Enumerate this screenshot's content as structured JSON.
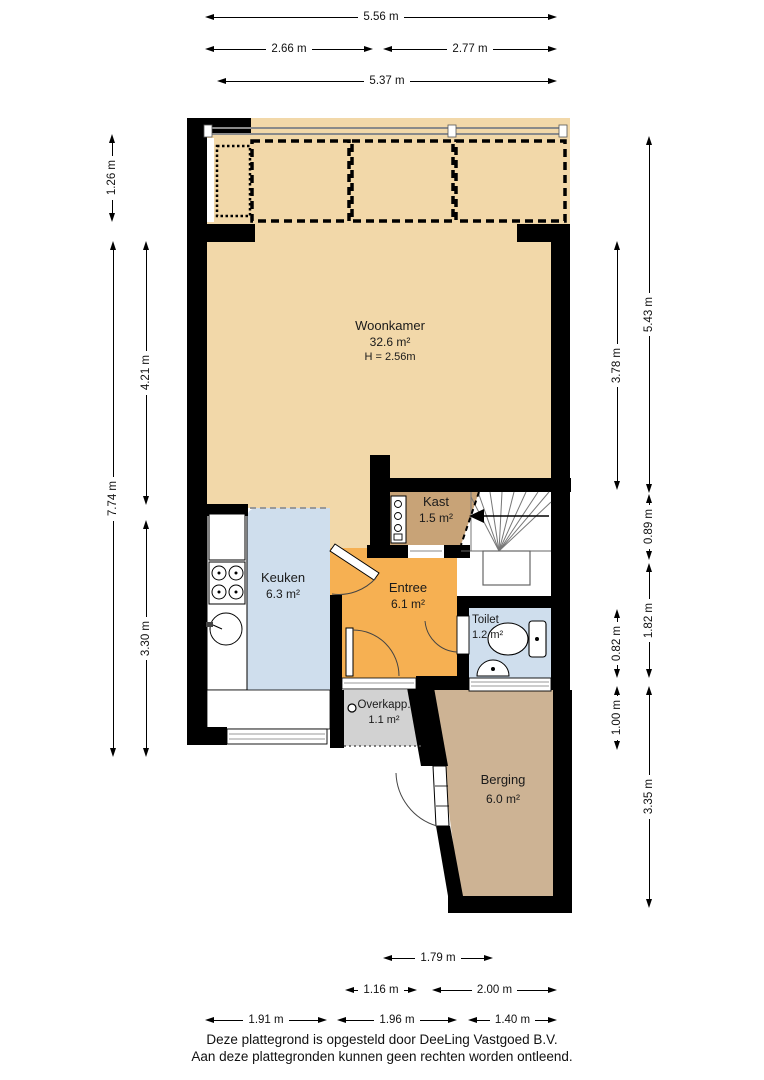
{
  "rooms": {
    "woonkamer": {
      "name": "Woonkamer",
      "area": "32.6 m²",
      "ceiling": "H = 2.56m"
    },
    "kast": {
      "name": "Kast",
      "area": "1.5 m²"
    },
    "keuken": {
      "name": "Keuken",
      "area": "6.3 m²"
    },
    "entree": {
      "name": "Entree",
      "area": "6.1 m²"
    },
    "toilet": {
      "name": "Toilet",
      "area": "1.2 m²"
    },
    "overkapping": {
      "name": "Overkapp.",
      "area": "1.1 m²"
    },
    "berging": {
      "name": "Berging",
      "area": "6.0 m²"
    }
  },
  "dimensions": {
    "top": [
      "5.56 m",
      "2.66 m",
      "2.77 m",
      "5.37 m"
    ],
    "left": [
      "1.26 m",
      "7.74 m",
      "4.21 m",
      "3.30 m"
    ],
    "right": [
      "5.43 m",
      "3.78 m",
      "0.89 m",
      "1.82 m",
      "0.82 m",
      "1.00 m",
      "3.35 m"
    ],
    "bottom": [
      "1.79 m",
      "1.16 m",
      "2.00 m",
      "1.91 m",
      "1.96 m",
      "1.40 m"
    ]
  },
  "footer": {
    "line1": "Deze plattegrond is opgesteld door DeeLing Vastgoed B.V.",
    "line2": "Aan deze plattegronden kunnen geen rechten worden ontleend."
  },
  "colors": {
    "wall": "#000000",
    "woonkamer": "#f2d8a9",
    "kast": "#c8a377",
    "keuken": "#cfdeed",
    "entree": "#f6b052",
    "toilet": "#cfdeed",
    "overkapping": "#d2d2d2",
    "berging": "#cdb394",
    "window_line": "#999999"
  }
}
